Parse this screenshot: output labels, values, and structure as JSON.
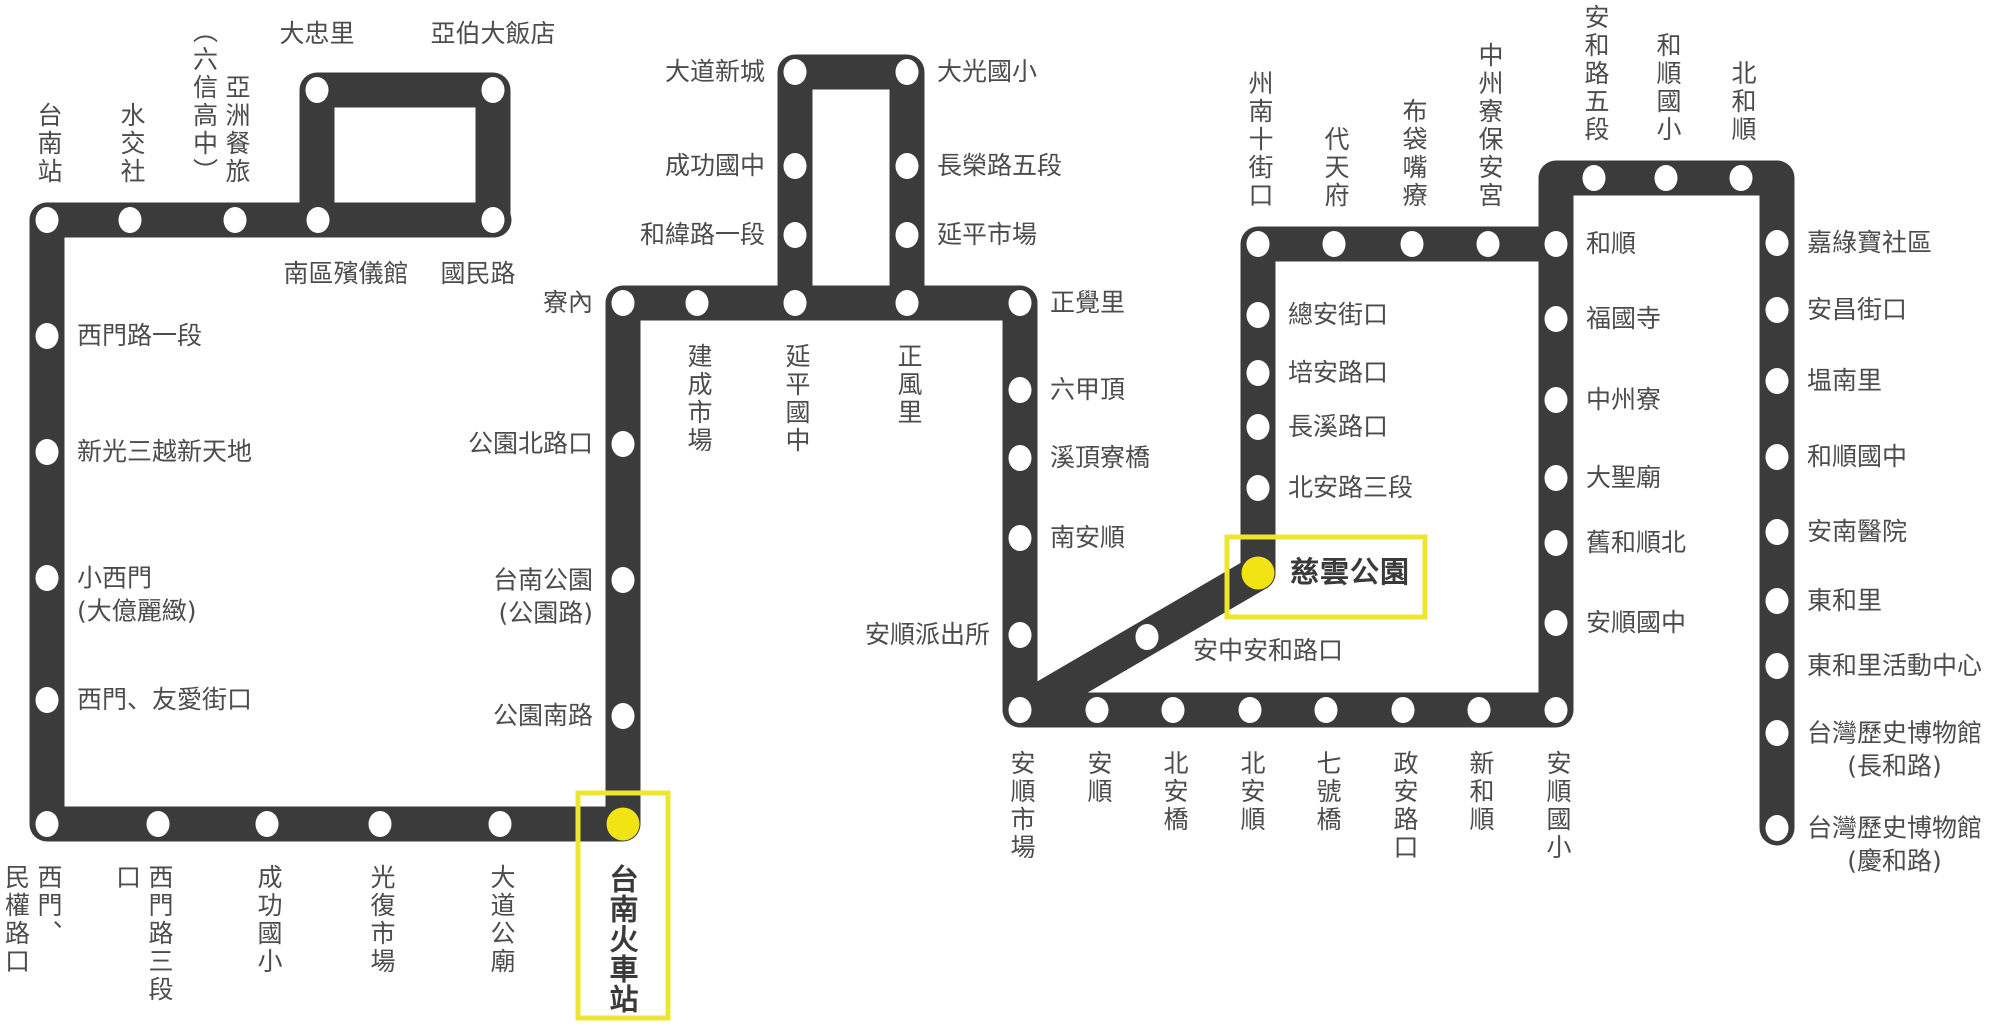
{
  "map": {
    "width": 2000,
    "height": 1030,
    "colors": {
      "route": "#3b3b3b",
      "station_dot": "#ffffff",
      "label_text": "#4c4c4c",
      "highlight_text": "#3a3a3a",
      "highlight_dot": "#f2e314",
      "highlight_box_border": "#ece531"
    },
    "route_segments": [
      {
        "name": "west-top-line",
        "points": [
          [
            47,
            220
          ],
          [
            494,
            220
          ]
        ]
      },
      {
        "name": "west-top-loop",
        "points": [
          [
            317,
            220
          ],
          [
            317,
            90
          ],
          [
            493,
            90
          ],
          [
            493,
            220
          ]
        ]
      },
      {
        "name": "west-main-line",
        "points": [
          [
            47,
            220
          ],
          [
            47,
            824
          ],
          [
            623,
            824
          ],
          [
            623,
            303
          ],
          [
            1020,
            303
          ]
        ]
      },
      {
        "name": "yanping-loop",
        "points": [
          [
            795,
            303
          ],
          [
            795,
            72
          ],
          [
            907,
            72
          ],
          [
            907,
            303
          ]
        ]
      },
      {
        "name": "east-main-line",
        "points": [
          [
            1020,
            303
          ],
          [
            1020,
            710
          ],
          [
            1556,
            710
          ],
          [
            1556,
            178
          ],
          [
            1777,
            178
          ],
          [
            1777,
            828
          ]
        ]
      },
      {
        "name": "ciyun-column",
        "points": [
          [
            1258,
            573
          ],
          [
            1258,
            244
          ],
          [
            1556,
            244
          ]
        ]
      },
      {
        "name": "ciyun-diagonal",
        "points": [
          [
            1258,
            573
          ],
          [
            1035,
            703
          ]
        ]
      }
    ],
    "highlight_boxes": [
      {
        "station": "台南火車站",
        "x": 578,
        "y": 793,
        "w": 90,
        "h": 225
      },
      {
        "station": "慈雲公園",
        "x": 1227,
        "y": 537,
        "w": 198,
        "h": 80
      }
    ],
    "stations": [
      {
        "label": "台南站",
        "x": 47,
        "y": 220,
        "lp": "va"
      },
      {
        "label": "水交社",
        "x": 130,
        "y": 220,
        "lp": "va"
      },
      {
        "label": "亞洲餐旅\n（六信高中）",
        "x": 235,
        "y": 220,
        "lp": "va"
      },
      {
        "label": "南區殯儀館",
        "x": 318,
        "y": 220,
        "lp": "cb",
        "dx": 28
      },
      {
        "label": "大忠里",
        "x": 317,
        "y": 90,
        "lp": "ca"
      },
      {
        "label": "亞伯大飯店",
        "x": 493,
        "y": 90,
        "lp": "ca"
      },
      {
        "label": "國民路",
        "x": 493,
        "y": 220,
        "lp": "cb",
        "dx": -15
      },
      {
        "label": "西門路一段",
        "x": 47,
        "y": 336,
        "lp": "r"
      },
      {
        "label": "新光三越新天地",
        "x": 47,
        "y": 452,
        "lp": "r"
      },
      {
        "label": "小西門\n(大億麗緻)",
        "x": 47,
        "y": 578,
        "lp": "r",
        "dy": 17
      },
      {
        "label": "西門、友愛街口",
        "x": 47,
        "y": 700,
        "lp": "r"
      },
      {
        "label": "西門、\n民權路口",
        "x": 47,
        "y": 824,
        "lp": "vb"
      },
      {
        "label": "西門路三段口",
        "x": 158,
        "y": 824,
        "lp": "vb"
      },
      {
        "label": "成功國小",
        "x": 267,
        "y": 824,
        "lp": "vb"
      },
      {
        "label": "光復市場",
        "x": 380,
        "y": 824,
        "lp": "vb"
      },
      {
        "label": "大道公廟",
        "x": 500,
        "y": 824,
        "lp": "vb"
      },
      {
        "label": "台南火車站",
        "x": 623,
        "y": 824,
        "lp": "vb",
        "hl": true,
        "key": "tainan-railway-station"
      },
      {
        "label": "公園南路",
        "x": 623,
        "y": 716,
        "lp": "l"
      },
      {
        "label": "台南公園\n(公園路)",
        "x": 623,
        "y": 580,
        "lp": "l",
        "align": "right",
        "dy": 17
      },
      {
        "label": "公園北路口",
        "x": 623,
        "y": 444,
        "lp": "l"
      },
      {
        "label": "寮內",
        "x": 623,
        "y": 303,
        "lp": "l"
      },
      {
        "label": "建成市場",
        "x": 697,
        "y": 303,
        "lp": "vb"
      },
      {
        "label": "延平國中",
        "x": 795,
        "y": 303,
        "lp": "vb"
      },
      {
        "label": "正風里",
        "x": 907,
        "y": 303,
        "lp": "vb"
      },
      {
        "label": "和緯路一段",
        "x": 795,
        "y": 235,
        "lp": "l"
      },
      {
        "label": "成功國中",
        "x": 795,
        "y": 166,
        "lp": "l"
      },
      {
        "label": "大道新城",
        "x": 795,
        "y": 72,
        "lp": "l"
      },
      {
        "label": "大光國小",
        "x": 907,
        "y": 72,
        "lp": "r"
      },
      {
        "label": "長榮路五段",
        "x": 907,
        "y": 166,
        "lp": "r"
      },
      {
        "label": "延平市場",
        "x": 907,
        "y": 235,
        "lp": "r"
      },
      {
        "label": "正覺里",
        "x": 1020,
        "y": 303,
        "lp": "r"
      },
      {
        "label": "六甲頂",
        "x": 1020,
        "y": 390,
        "lp": "r"
      },
      {
        "label": "溪頂寮橋",
        "x": 1020,
        "y": 458,
        "lp": "r"
      },
      {
        "label": "南安順",
        "x": 1020,
        "y": 538,
        "lp": "r"
      },
      {
        "label": "安順派出所",
        "x": 1020,
        "y": 635,
        "lp": "l"
      },
      {
        "label": "安順市場",
        "x": 1020,
        "y": 710,
        "lp": "vb"
      },
      {
        "label": "安順",
        "x": 1097,
        "y": 710,
        "lp": "vb"
      },
      {
        "label": "北安橋",
        "x": 1173,
        "y": 710,
        "lp": "vb"
      },
      {
        "label": "北安順",
        "x": 1250,
        "y": 710,
        "lp": "vb"
      },
      {
        "label": "七號橋",
        "x": 1326,
        "y": 710,
        "lp": "vb"
      },
      {
        "label": "政安路口",
        "x": 1403,
        "y": 710,
        "lp": "vb"
      },
      {
        "label": "新和順",
        "x": 1479,
        "y": 710,
        "lp": "vb"
      },
      {
        "label": "安順國小",
        "x": 1556,
        "y": 710,
        "lp": "vb"
      },
      {
        "label": "安中安和路口",
        "x": 1147,
        "y": 637,
        "lp": "r",
        "dx": 16,
        "dy": 14
      },
      {
        "label": "慈雲公園",
        "x": 1258,
        "y": 573,
        "lp": "r",
        "hl": true,
        "dx": 2,
        "key": "ciyun-park"
      },
      {
        "label": "北安路三段",
        "x": 1258,
        "y": 488,
        "lp": "r"
      },
      {
        "label": "長溪路口",
        "x": 1258,
        "y": 427,
        "lp": "r"
      },
      {
        "label": "培安路口",
        "x": 1258,
        "y": 373,
        "lp": "r"
      },
      {
        "label": "總安街口",
        "x": 1258,
        "y": 315,
        "lp": "r"
      },
      {
        "label": "州南十街口",
        "x": 1258,
        "y": 244,
        "lp": "va"
      },
      {
        "label": "代天府",
        "x": 1334,
        "y": 244,
        "lp": "va"
      },
      {
        "label": "布袋嘴療",
        "x": 1412,
        "y": 244,
        "lp": "va"
      },
      {
        "label": "中州寮保安宮",
        "x": 1488,
        "y": 244,
        "lp": "va"
      },
      {
        "label": "和順",
        "x": 1556,
        "y": 244,
        "lp": "r"
      },
      {
        "label": "福國寺",
        "x": 1556,
        "y": 319,
        "lp": "r"
      },
      {
        "label": "中州寮",
        "x": 1556,
        "y": 400,
        "lp": "r"
      },
      {
        "label": "大聖廟",
        "x": 1556,
        "y": 478,
        "lp": "r"
      },
      {
        "label": "舊和順北",
        "x": 1556,
        "y": 543,
        "lp": "r"
      },
      {
        "label": "安順國中",
        "x": 1556,
        "y": 623,
        "lp": "r"
      },
      {
        "label": "安和路五段",
        "x": 1594,
        "y": 178,
        "lp": "va"
      },
      {
        "label": "和順國小",
        "x": 1666,
        "y": 178,
        "lp": "va"
      },
      {
        "label": "北和順",
        "x": 1741,
        "y": 178,
        "lp": "va"
      },
      {
        "label": "嘉綠寶社區",
        "x": 1777,
        "y": 243,
        "lp": "r"
      },
      {
        "label": "安昌街口",
        "x": 1777,
        "y": 310,
        "lp": "r"
      },
      {
        "label": "塭南里",
        "x": 1777,
        "y": 381,
        "lp": "r"
      },
      {
        "label": "和順國中",
        "x": 1777,
        "y": 457,
        "lp": "r"
      },
      {
        "label": "安南醫院",
        "x": 1777,
        "y": 532,
        "lp": "r"
      },
      {
        "label": "東和里",
        "x": 1777,
        "y": 601,
        "lp": "r"
      },
      {
        "label": "東和里活動中心",
        "x": 1777,
        "y": 666,
        "lp": "r"
      },
      {
        "label": "台灣歷史博物館\n(長和路)",
        "x": 1777,
        "y": 733,
        "lp": "r",
        "align": "center",
        "dy": 17
      },
      {
        "label": "台灣歷史博物館\n(慶和路)",
        "x": 1777,
        "y": 828,
        "lp": "r",
        "align": "center",
        "dy": 17
      }
    ]
  }
}
